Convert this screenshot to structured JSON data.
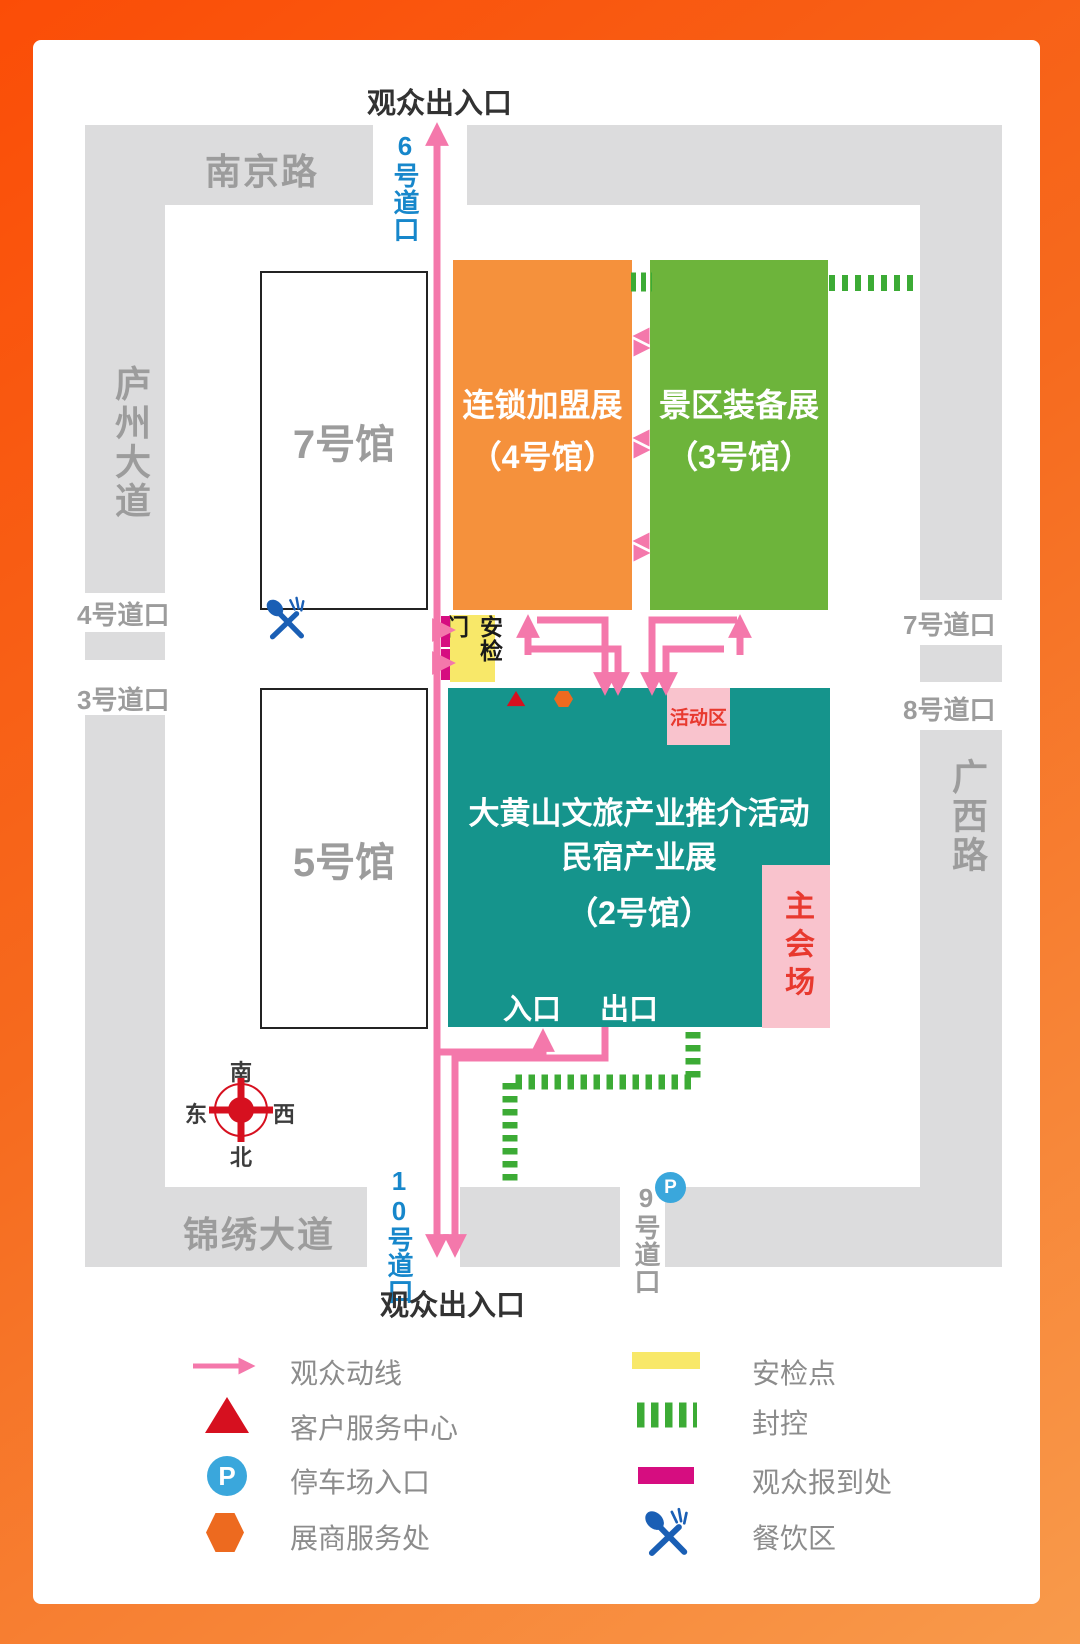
{
  "title": {
    "top_entrance": "观众出入口",
    "bottom_entrance": "观众出入口"
  },
  "roads": {
    "north": "南京路",
    "west": "庐州大道",
    "east": "广西路",
    "south": "锦绣大道"
  },
  "gates": {
    "gate3": "3号道口",
    "gate4": "4号道口",
    "gate6": "6号道口",
    "gate7": "7号道口",
    "gate8": "8号道口",
    "gate9": "9号道口",
    "gate10": "10号道口"
  },
  "halls": {
    "hall7": {
      "name": "7号馆"
    },
    "hall5": {
      "name": "5号馆"
    },
    "hall4": {
      "line1": "连锁加盟展",
      "line2": "（4号馆）"
    },
    "hall3": {
      "line1": "景区装备展",
      "line2": "（3号馆）"
    },
    "hall2": {
      "line1": "大黄山文旅产业推介活动",
      "line2": "民宿产业展",
      "line3": "（2号馆）",
      "entrance": "入口",
      "exit": "出口"
    }
  },
  "areas": {
    "activity": "活动区",
    "main_venue": "主会场",
    "security_gate": "安检门",
    "parking_letter": "P"
  },
  "compass": {
    "top": "南",
    "bottom": "北",
    "left": "东",
    "right": "西"
  },
  "legend": [
    {
      "icon": "flow-arrow",
      "label": "观众动线"
    },
    {
      "icon": "red-triangle",
      "label": "客户服务中心"
    },
    {
      "icon": "parking",
      "label": "停车场入口"
    },
    {
      "icon": "orange-hexagon",
      "label": "展商服务处"
    },
    {
      "icon": "yellow-bar",
      "label": "安检点"
    },
    {
      "icon": "green-dashes",
      "label": "封控"
    },
    {
      "icon": "magenta-bar",
      "label": "观众报到处"
    },
    {
      "icon": "dining",
      "label": "餐饮区"
    }
  ],
  "colors": {
    "frame_orange_start": "#fb4d07",
    "frame_orange_end": "#f89a4b",
    "hall4_orange": "#f5913c",
    "hall3_green": "#6db43b",
    "hall2_teal": "#15948c",
    "road_gray": "#dcdcdd",
    "flow_pink": "#f478ab",
    "checkin_magenta": "#d60d80",
    "security_yellow": "#f8e869",
    "barrier_green": "#3cab35",
    "area_pink": "#f9c3cd",
    "gate_blue": "#1787cb",
    "service_red": "#d6101f",
    "exhibitor_orange": "#ed6a1f",
    "dining_blue": "#1a5fb5",
    "parking_blue": "#3aa7dc"
  }
}
